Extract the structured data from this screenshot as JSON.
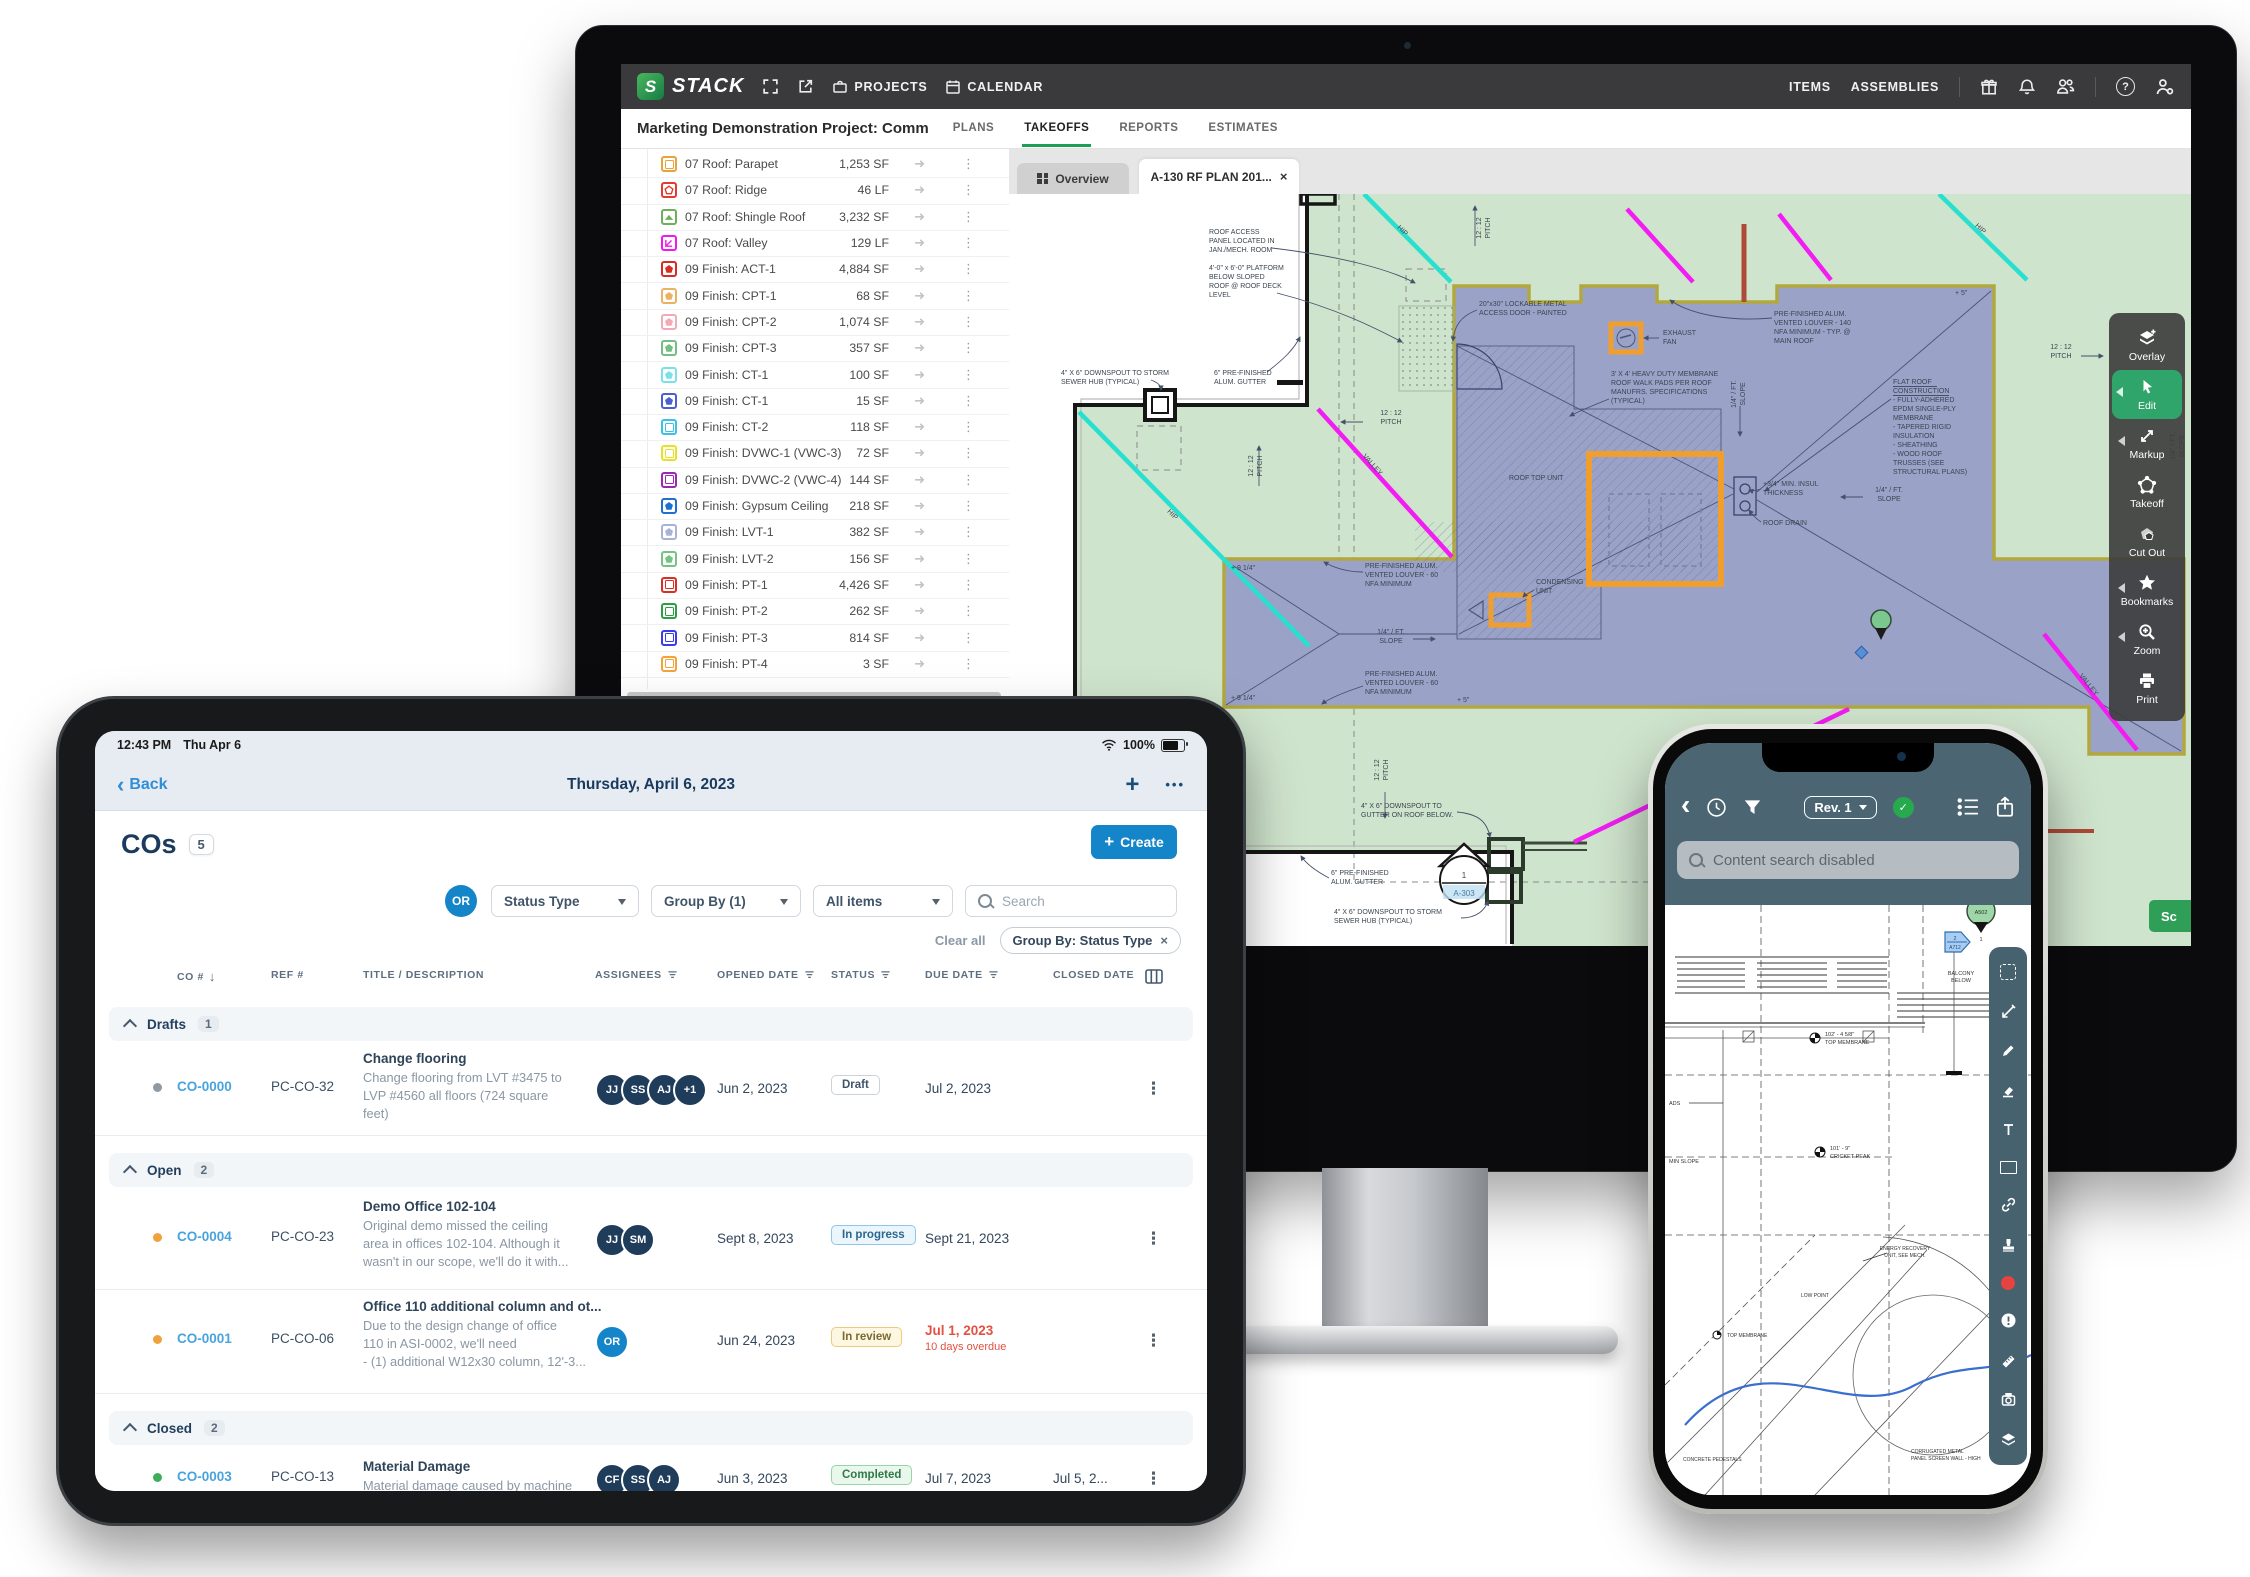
{
  "icons": {
    "close": "×",
    "kebab": "⋮",
    "back": "‹",
    "plus": "+",
    "more": "•••",
    "help": "?",
    "check": "✓",
    "sort": "↓",
    "arrow": "➜"
  },
  "colors": {
    "brand_green": "#1e9e57",
    "edit_active": "#2fa56b",
    "tablet_blue": "#1485c8",
    "link_blue": "#49a3dc",
    "overdue_red": "#e25141",
    "plan_green": "#cfe4cd",
    "plan_lavender": "#9aa2c8",
    "plan_olive": "#b3a83f",
    "plan_orange": "#f09f2e",
    "plan_magenta": "#f21df2",
    "plan_cyan": "#27e0cf",
    "phone_slate": "#4b6672"
  },
  "monitor": {
    "topbar": {
      "brand": "STACK",
      "projects": "PROJECTS",
      "calendar": "CALENDAR",
      "items": "ITEMS",
      "assemblies": "ASSEMBLIES"
    },
    "project_header": {
      "title": "Marketing Demonstration Project: Comm",
      "tabs": [
        "PLANS",
        "TAKEOFFS",
        "REPORTS",
        "ESTIMATES"
      ]
    },
    "plan_tabs": {
      "overview": "Overview",
      "sheet": "A-130 RF PLAN 201..."
    },
    "tools": [
      "Overlay",
      "Edit",
      "Markup",
      "Takeoff",
      "Cut Out",
      "Bookmarks",
      "Zoom",
      "Print"
    ],
    "takeoffs": [
      {
        "label": "07 Roof: Parapet",
        "qty": "1,253 SF",
        "style": "color:#e8a33d"
      },
      {
        "label": "07 Roof: Ridge",
        "qty": "46 LF",
        "style": "color:#e03c31"
      },
      {
        "label": "07 Roof: Shingle Roof",
        "qty": "3,232 SF",
        "style": "color:#6fae5c"
      },
      {
        "label": "07 Roof: Valley",
        "qty": "129 LF",
        "style": "color:#f017f0"
      },
      {
        "label": "09 Finish: ACT-1",
        "qty": "4,884 SF",
        "style": "color:#d92b22"
      },
      {
        "label": "09 Finish: CPT-1",
        "qty": "68 SF",
        "style": "color:#eab363"
      },
      {
        "label": "09 Finish: CPT-2",
        "qty": "1,074 SF",
        "style": "color:#f2aab6"
      },
      {
        "label": "09 Finish: CPT-3",
        "qty": "357 SF",
        "style": "color:#74bd85"
      },
      {
        "label": "09 Finish: CT-1",
        "qty": "100 SF",
        "style": "color:#7ce0ea"
      },
      {
        "label": "09 Finish: CT-1",
        "qty": "15 SF",
        "style": "color:#4d5ed0"
      },
      {
        "label": "09 Finish: CT-2",
        "qty": "118 SF",
        "style": "color:#39c1e8"
      },
      {
        "label": "09 Finish: DVWC-1 (VWC-3)",
        "qty": "72 SF",
        "style": "color:#e8e227"
      },
      {
        "label": "09 Finish: DVWC-2 (VWC-4)",
        "qty": "144 SF",
        "style": "color:#9c27b0"
      },
      {
        "label": "09 Finish: Gypsum Ceiling",
        "qty": "218 SF",
        "style": "color:#1f6fd0"
      },
      {
        "label": "09 Finish: LVT-1",
        "qty": "382 SF",
        "style": "color:#a9b3d6"
      },
      {
        "label": "09 Finish: LVT-2",
        "qty": "156 SF",
        "style": "color:#74c484"
      },
      {
        "label": "09 Finish: PT-1",
        "qty": "4,426 SF",
        "style": "color:#d93025"
      },
      {
        "label": "09 Finish: PT-2",
        "qty": "262 SF",
        "style": "color:#2e9e44"
      },
      {
        "label": "09 Finish: PT-3",
        "qty": "814 SF",
        "style": "color:#3b3bec"
      },
      {
        "label": "09 Finish: PT-4",
        "qty": "3 SF",
        "style": "color:#f2a33c"
      }
    ],
    "plan": {
      "roof_access": [
        "ROOF ACCESS",
        "PANEL LOCATED IN",
        "JAN./MECH. ROOM"
      ],
      "platform": [
        "4'-0\" x 6'-0\" PLATFORM",
        "BELOW SLOPED",
        "ROOF @ ROOF DECK",
        "LEVEL"
      ],
      "downspout_storm": [
        "4\" X 6\" DOWNSPOUT TO STORM",
        "SEWER HUB (TYPICAL)"
      ],
      "gutter": [
        "6\" PRE-FINISHED",
        "ALUM. GUTTER"
      ],
      "louver140": [
        "PRE-FINISHED ALUM.",
        "VENTED LOUVER - 140",
        "NFA MINIMUM - TYP. @",
        "MAIN ROOF"
      ],
      "access_door": [
        "20\"x30\" LOCKABLE METAL",
        "ACCESS DOOR - PAINTED"
      ],
      "exhaust": [
        "EXHAUST",
        "FAN"
      ],
      "walk_pads": [
        "3' X 4' HEAVY DUTY MEMBRANE",
        "ROOF WALK PADS PER ROOF",
        "MANUFRS. SPECIFICATIONS",
        "(TYPICAL)"
      ],
      "flat_roof": [
        "FLAT ROOF",
        "CONSTRUCTION",
        "- FULLY-ADHERED",
        "EPDM SINGLE-PLY",
        "MEMBRANE",
        "- TAPERED RIGID",
        "INSULATION",
        "- SHEATHING",
        "- WOOD ROOF",
        "TRUSSES (SEE",
        "STRUCTURAL PLANS)"
      ],
      "insul": [
        "+3/4\" MIN. INSUL",
        "THICKNESS"
      ],
      "roof_drain": "ROOF DRAIN",
      "rtu": "ROOF TOP UNIT",
      "condensing": [
        "CONDENSING",
        "UNIT"
      ],
      "louver60": [
        "PRE-FINISHED ALUM.",
        "VENTED LOUVER - 60",
        "NFA MINIMUM"
      ],
      "downspout_below": [
        "4\" X 6\" DOWNSPOUT TO",
        "GUTTER ON ROOF BELOW."
      ],
      "slope": [
        "1/4\" / FT.",
        "SLOPE"
      ],
      "pitch": [
        "12 : 12",
        "PITCH"
      ],
      "valley": "VALLEY",
      "hip": "HIP",
      "plus5": "+ 5\"",
      "plus914": "+ 9 1/4\"",
      "bubble": {
        "num": "1",
        "sheet": "A-303"
      },
      "sc": "Sc"
    }
  },
  "tablet": {
    "status": {
      "time": "12:43 PM",
      "date": "Thu Apr 6",
      "battery": "100%"
    },
    "nav": {
      "back": "Back",
      "title": "Thursday, April 6, 2023"
    },
    "head": {
      "title": "COs",
      "count": "5",
      "create": "Create"
    },
    "filters": {
      "owner": "OR",
      "status_type": "Status Type",
      "group_by": "Group By (1)",
      "items": "All items",
      "search": "Search",
      "clear": "Clear all",
      "chip": "Group By: Status Type"
    },
    "cols": [
      "CO #",
      "REF #",
      "TITLE / DESCRIPTION",
      "ASSIGNEES",
      "OPENED DATE",
      "STATUS",
      "DUE DATE",
      "CLOSED DATE"
    ],
    "groups": {
      "drafts": {
        "label": "Drafts",
        "count": "1"
      },
      "open": {
        "label": "Open",
        "count": "2"
      },
      "closed": {
        "label": "Closed",
        "count": "2"
      }
    },
    "rows": {
      "r1": {
        "dot_style": "background:#8f9aa3",
        "co": "CO-0000",
        "ref": "PC-CO-32",
        "title": "Change flooring",
        "desc": [
          "Change flooring from LVT #3475 to",
          "LVP #4560 all floors (724 square",
          "feet)"
        ],
        "avatars": [
          "JJ",
          "SS",
          "AJ",
          "+1"
        ],
        "opened": "Jun 2, 2023",
        "status": "Draft",
        "status_style": "background:#fff;border-color:#c9d3db;color:#3f5468",
        "due": "Jul 2, 2023"
      },
      "r2": {
        "dot_style": "background:#f0a13e",
        "co": "CO-0004",
        "ref": "PC-CO-23",
        "title": "Demo Office 102-104",
        "desc": [
          "Original demo missed the ceiling",
          "area in offices 102-104. Although it",
          "wasn't in our scope, we'll do it with..."
        ],
        "avatars": [
          "JJ",
          "SM"
        ],
        "opened": "Sept 8, 2023",
        "status": "In progress",
        "status_style": "background:#eaf5fc;border-color:#8fc6e9;color:#2c6690",
        "due": "Sept 21, 2023"
      },
      "r3": {
        "dot_style": "background:#f0a13e",
        "co": "CO-0001",
        "ref": "PC-CO-06",
        "title": "Office 110 additional column and ot...",
        "desc": [
          "Due to the design change of office",
          "110 in ASI-0002, we'll need",
          "- (1) additional W12x30 column, 12'-3..."
        ],
        "avatars": [
          "OR"
        ],
        "opened": "Jun 24, 2023",
        "status": "In review",
        "status_style": "background:#fdf6e0;border-color:#edcb7e;color:#7a6a33",
        "due": "Jul 1, 2023",
        "overdue": "10 days overdue"
      },
      "r4": {
        "dot_style": "background:#3fae5c",
        "co": "CO-0003",
        "ref": "PC-CO-13",
        "title": "Material Damage",
        "desc": [
          "Material damage caused by machine"
        ],
        "avatars": [
          "CF",
          "SS",
          "AJ"
        ],
        "opened": "Jun 3, 2023",
        "status": "Completed",
        "status_style": "background:#e9f7ed;border-color:#94d6a4;color:#2f7a48",
        "due": "Jul 7, 2023",
        "closed": "Jul 5, 2..."
      },
      "r5": {
        "dot_style": "background:#3fae5c",
        "co": "CO-0002",
        "ref": "PC-CO-12",
        "title": "General Labor",
        "avatars": [
          "RL"
        ],
        "opened": "Jun 1, 2023",
        "status": "Voided",
        "status_style": "background:#f2f4f6;border-color:#ccd5dc;color:#6b7885",
        "due": "Jul 3, 2023",
        "closed": "Jul 1, 20..."
      }
    }
  },
  "phone": {
    "header": {
      "rev": "Rev. 1"
    },
    "search": "Content search disabled",
    "plan": {
      "balcony": [
        "BALCONY",
        "BELOW"
      ],
      "elev1": [
        "102' - 4 5/8\"",
        "TOP MEMBRANE"
      ],
      "elev2": [
        "101' - 9\"",
        "CRICKET PEAK"
      ],
      "min_slope": "MIN SLOPE",
      "ads": "ADS",
      "pin": "A502",
      "pin_num": "1",
      "flag_num": "2",
      "flag_sheet": "A712",
      "eru": [
        "ENERGY RECOVERY",
        "UNIT, SEE MECH."
      ],
      "low_point": "LOW POINT",
      "membrane": "TOP MEMBRANE",
      "pedestals": "CONCRETE PEDESTALS",
      "screen_wall": [
        "CORRUGATED METAL",
        "PANEL SCREEN WALL - HIGH"
      ]
    }
  }
}
